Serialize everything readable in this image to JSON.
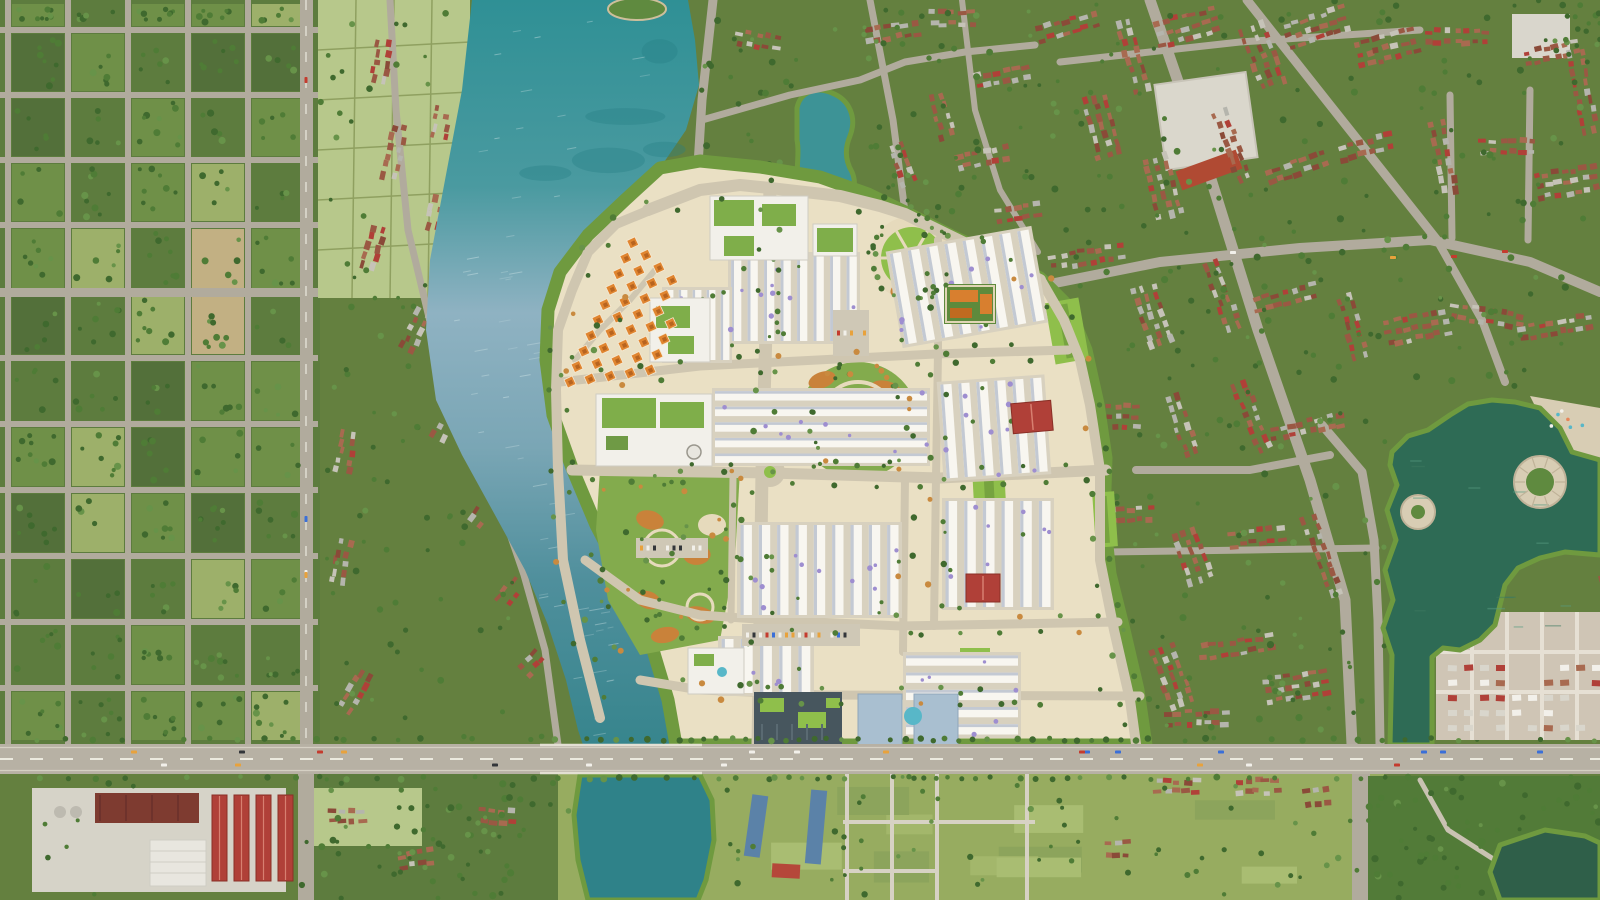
{
  "scene": {
    "type": "aerial_masterplan_render",
    "subject": "Top-down aerial render of a new riverside township development inside an existing low-rise city",
    "view": "orthographic top-down, afternoon light",
    "text_present": false
  },
  "regions": [
    {
      "name": "left-grid-district",
      "description": "Tree-filled superblock grid with gray streets on the far west"
    },
    {
      "name": "west-riverbank-village",
      "description": "Red-roofed village houses along a winding river-bank road"
    },
    {
      "name": "river",
      "description": "Turquoise-to-blue river curving through the center-left with a small island at top"
    },
    {
      "name": "masterplan-township",
      "description": "Cream new township: arcs of orange-roof villas, white shophouse rows, circular parks with orange planting, schools with green roofs, glass and blue towers along the main road"
    },
    {
      "name": "northeast-village",
      "description": "Existing village with a teal pond and an orange temple compound"
    },
    {
      "name": "right-city-district",
      "description": "Dense brown-roofed housing along diagonal avenues with a white sports field"
    },
    {
      "name": "right-lake",
      "description": "Dark green lake with circular ring island, round shore plaza and sand beach"
    },
    {
      "name": "green-channel",
      "description": "Green canal running from the lake down to the main road"
    },
    {
      "name": "main-road",
      "description": "East-west arterial with street trees, dashed lanes, traffic and a river bridge"
    },
    {
      "name": "industrial-campus",
      "description": "Red-roofed factory halls and concrete yards at bottom left"
    },
    {
      "name": "south-farmland",
      "description": "Paddy fields, farm lanes, blue-roofed sheds and ponds below the road"
    }
  ],
  "approx_counts": {
    "villas": 38,
    "rowhouse_blocks": 9,
    "red_roof_buildings": 3,
    "lakes": 2
  },
  "palette": {
    "ground": "#64803f",
    "districtGreen": "#5d7c3e",
    "cellLight": "#6f9048",
    "cellPale": "#9db06a",
    "cellDark": "#53703a",
    "fieldPale": "#b7c88b",
    "fieldGreen": "#97ac60",
    "parkGreen": "#527b38",
    "road": "#b1ab9d",
    "roadMajor": "#b7b1a4",
    "roadDash": "#eceadf",
    "creamRoad": "#cfc6b0",
    "riverTop": "#2f9095",
    "riverMid": "#8fb2c2",
    "riverLow": "#4f8f9c",
    "pond": "#2f8289",
    "pondTeal": "#3d9396",
    "lakeRight": "#2e6b55",
    "pondDark": "#2f5f49",
    "cream": "#eae0c4",
    "plazaCream": "#e6dabc",
    "sand": "#d8cdb4",
    "rowWhite": "#f8f6f0",
    "rowShadow": "#c3c9d3",
    "blockBase": "#d8d1bf",
    "lawn": "#8fbf4b",
    "lawnDark": "#76a33f",
    "purpleTree": "#9e8ed0",
    "treeDark": "#3f692e",
    "treeMid": "#4f7c36",
    "treeLight": "#679349",
    "autumn": "#c98a3f",
    "villa": "#e08530",
    "villaDark": "#b8641f",
    "parkOrange": "#c9823a",
    "redRoof": "#b04038",
    "darkRedRoof": "#7e3b30",
    "blueRoof": "#5b82a8",
    "glass": "#47565e",
    "blueTower": "#a9bfd0",
    "tealPool": "#58b7c8",
    "concrete": "#d6d3c8",
    "white": "#f2f0ea",
    "subBase": "#cfc5b5",
    "houseBrown": "#9a5843",
    "houseRust": "#a86a50",
    "houseDark": "#8a4a38",
    "houseGray": "#b5b5ad",
    "houseLight": "#c6c3b8",
    "islandGreen": "#5f8a3f"
  }
}
